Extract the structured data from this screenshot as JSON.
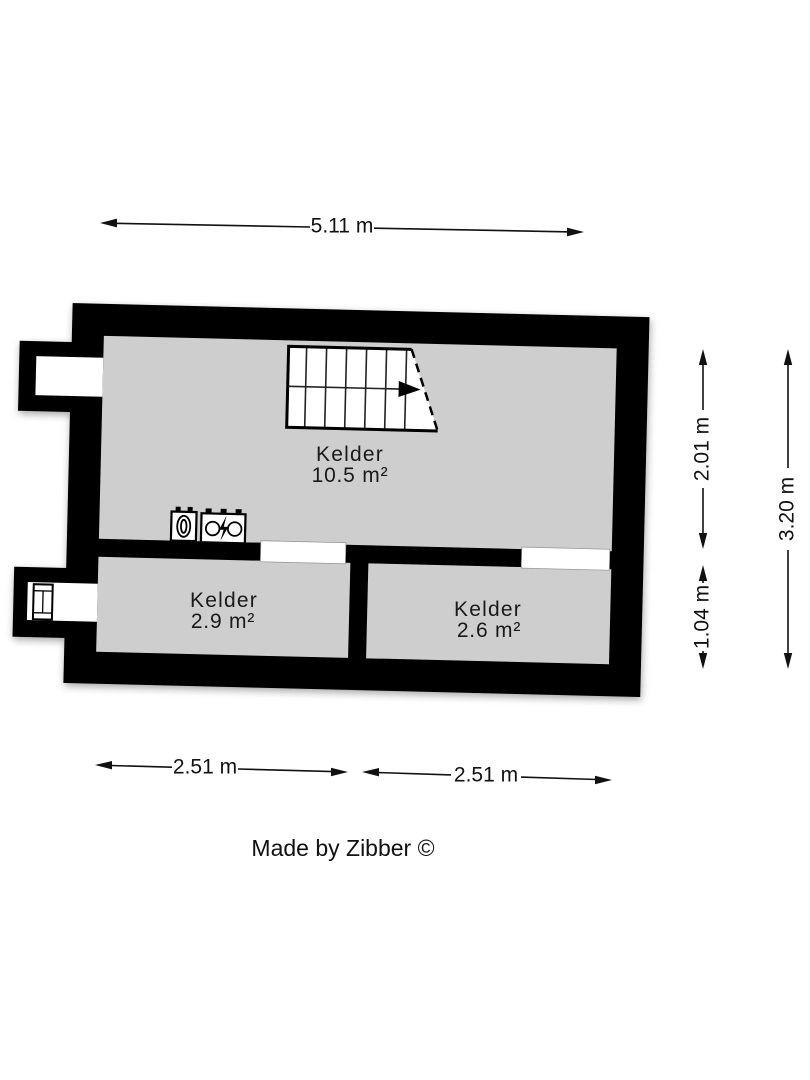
{
  "floor_plan": {
    "credit": "Made by Zibber ©",
    "rooms": [
      {
        "name": "Kelder",
        "area": "10.5 m²"
      },
      {
        "name": "Kelder",
        "area": "2.9 m²"
      },
      {
        "name": "Kelder",
        "area": "2.6 m²"
      }
    ],
    "dimensions": {
      "top_width": "5.11 m",
      "right_upper": "2.01 m",
      "right_lower": "1.04 m",
      "right_total": "3.20 m",
      "bottom_left_width": "2.51 m",
      "bottom_right_width": "2.51 m"
    },
    "icons": [
      "stairs-direction-arrow-icon",
      "heater-icon",
      "electricity-meter-icon",
      "window-icon"
    ],
    "colors": {
      "wall": "#000000",
      "floor": "#cecece",
      "background": "#ffffff",
      "text": "#1a1a1a"
    }
  }
}
